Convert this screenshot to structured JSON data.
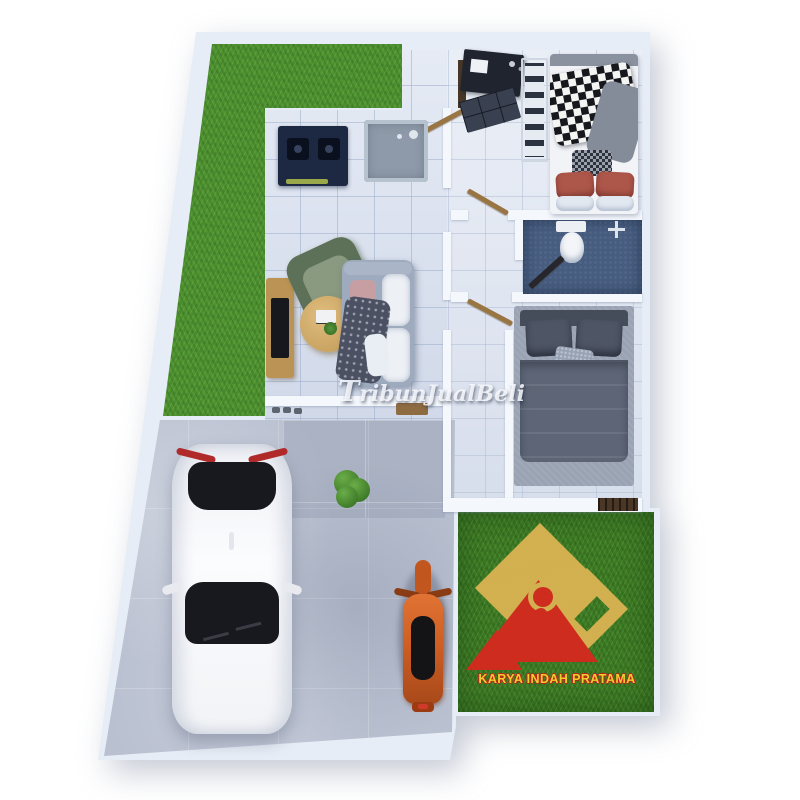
{
  "watermark": {
    "text": "TribunJualBeli"
  },
  "logo": {
    "company": "KARYA INDAH PRATAMA"
  },
  "palette": {
    "background": "#ffffff",
    "wall": "#e7edf6",
    "wall2": "#f4f8fd",
    "tile_floor": "#d8e0ef",
    "front_grass": "#4f9330",
    "back_grass": "#3e7c24",
    "concrete": "#b9c0d0",
    "bathroom_floor": "#475d80",
    "stove": "#1d2942",
    "wood": "#bb9355",
    "sofa": "#9eabbf",
    "armchair": "#5d7158",
    "bed1_duvet": "#f1f3f7",
    "bed2_duvet": "#5d6576",
    "rug": "#9aa3b3",
    "car_body": "#f2f3f6",
    "car_glass": "#17191e",
    "motorbike": "#cf5f24",
    "door_wood": "#9a7544",
    "logo_gold": "#d9b352",
    "logo_red": "#d42a1e",
    "logo_text": "#f5d231"
  },
  "objects": [
    "front-yard-grass",
    "kitchen-stove",
    "kitchen-sink",
    "living-armchair",
    "living-sofa",
    "coffee-table",
    "tv-console",
    "bedroom1-bed",
    "wardrobe",
    "desk",
    "dresser",
    "bathroom-toilet",
    "shower-fixture",
    "bedroom2-bed",
    "area-rug",
    "terrace-plant",
    "white-car",
    "orange-motorcycle",
    "backyard-grass",
    "company-logo",
    "site-watermark"
  ]
}
